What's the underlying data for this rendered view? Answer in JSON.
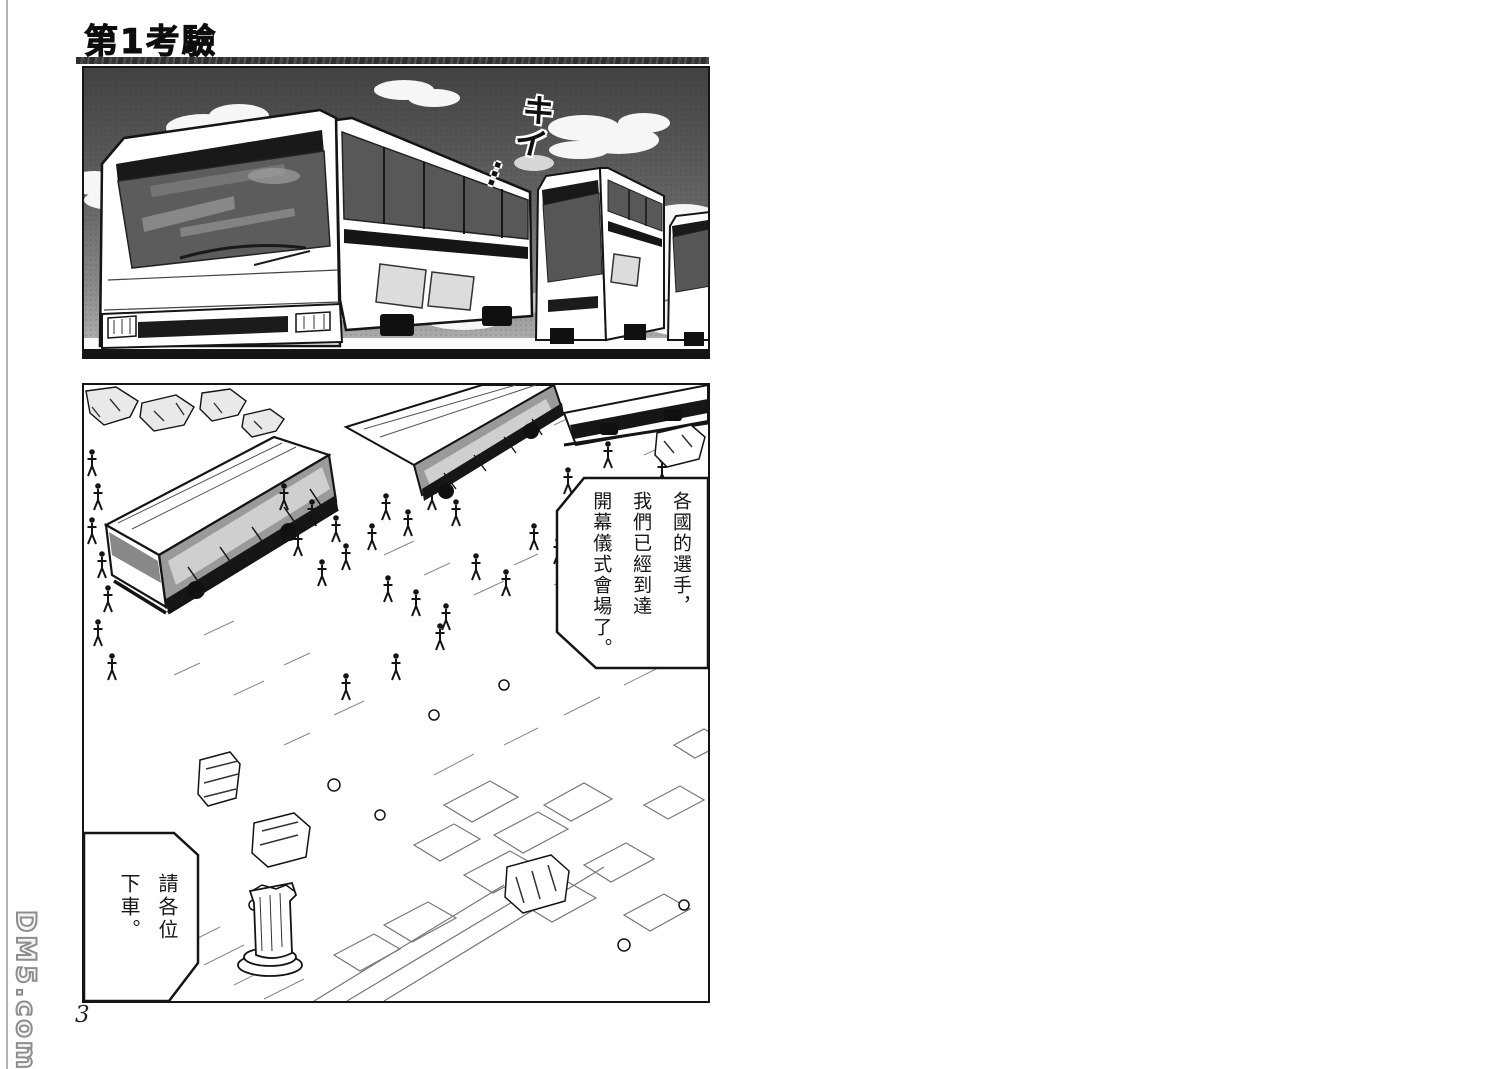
{
  "page": {
    "title": "第1考驗",
    "page_number": "3",
    "watermark": "DM5.com"
  },
  "panels": {
    "top": {
      "sfx": "キイ",
      "sfx_trail": "…"
    },
    "bottom": {
      "bubble_arrival": "各國的選手，\n我們已經到達\n開幕儀式會場了。",
      "bubble_getoff": "請各位\n下車。"
    }
  },
  "colors": {
    "ink": "#141414",
    "paper": "#ffffff",
    "sky_dark": "#454545",
    "sky_light": "#b5b5b5",
    "window_gray": "#585858",
    "watermark_gray": "#8d8d8d"
  }
}
